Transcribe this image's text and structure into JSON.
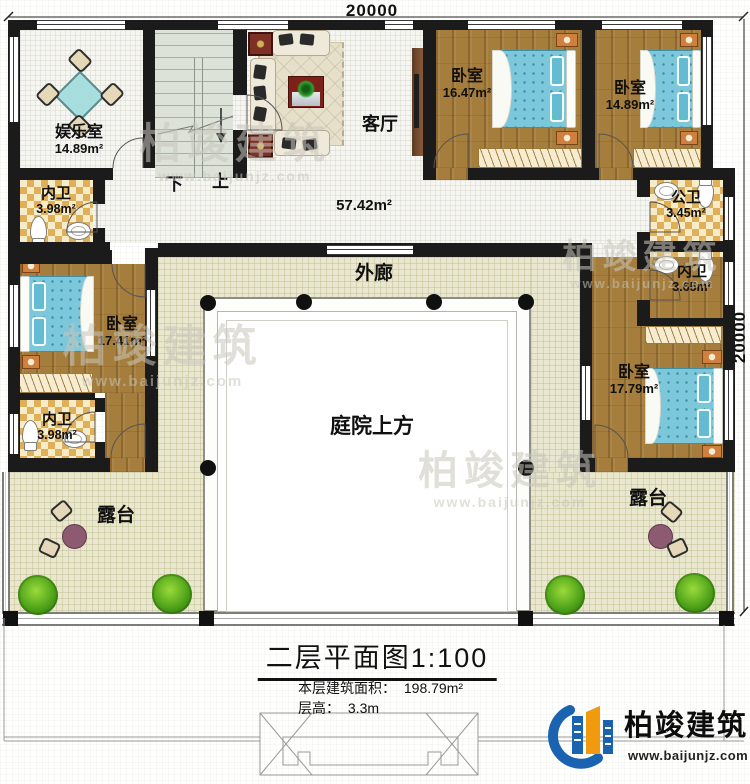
{
  "dimensions": {
    "top": "20000",
    "right": "20000"
  },
  "rooms": {
    "entertainment": {
      "label": "娱乐室",
      "area": "14.89m²"
    },
    "bath_top_left": {
      "label": "内卫",
      "area": "3.98m²"
    },
    "living": {
      "label": "客厅",
      "area": "57.42m²"
    },
    "bedroom_ne1": {
      "label": "卧室",
      "area": "16.47m²"
    },
    "bedroom_ne2": {
      "label": "卧室",
      "area": "14.89m²"
    },
    "public_bath": {
      "label": "公卫",
      "area": "3.45m²"
    },
    "bath_right": {
      "label": "内卫",
      "area": "3.65m²"
    },
    "bedroom_west": {
      "label": "卧室",
      "area": "17.41m²"
    },
    "bedroom_east": {
      "label": "卧室",
      "area": "17.79m²"
    },
    "bath_bottom_left": {
      "label": "内卫",
      "area": "3.98m²"
    },
    "veranda": {
      "label": "外廊"
    },
    "courtyard": {
      "label": "庭院上方"
    },
    "terrace_left": {
      "label": "露台"
    },
    "terrace_right": {
      "label": "露台"
    }
  },
  "stairs": {
    "down": "下",
    "up": "上"
  },
  "title_block": {
    "title": "二层平面图",
    "scale": "1:100",
    "area_label": "本层建筑面积：",
    "area_value": "198.79m²",
    "height_label": "层高：",
    "height_value": "3.3m"
  },
  "brand": {
    "name": "柏竣建筑",
    "website": "www.baijunjz.com"
  },
  "watermark": {
    "name": "柏竣建筑",
    "website": "www.baijunjz.com"
  },
  "colors": {
    "wall": "#1b1b1b",
    "wood": "#a57d3c",
    "bed": "#7cc7da",
    "brand_blue": "#1a63b0",
    "brand_orange": "#f29a0d"
  }
}
